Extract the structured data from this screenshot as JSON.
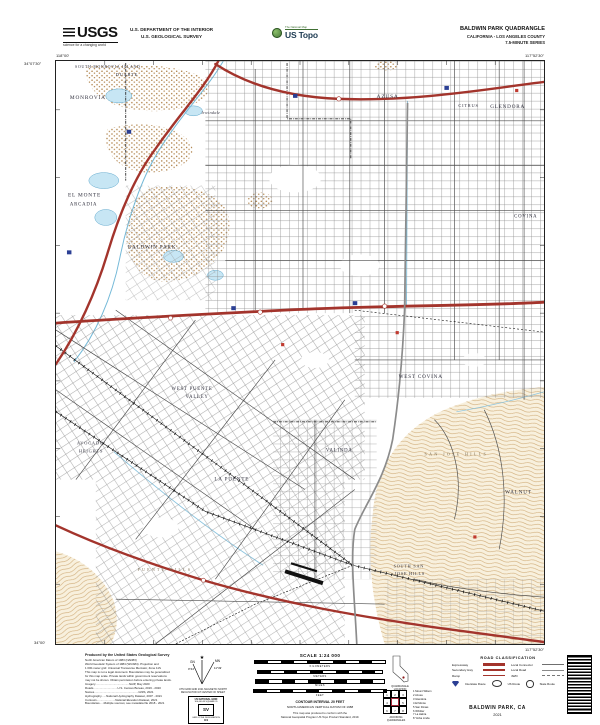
{
  "header": {
    "usgs": "USGS",
    "usgs_tagline": "science for a changing world",
    "dept1": "U.S. DEPARTMENT OF THE INTERIOR",
    "dept2": "U.S. GEOLOGICAL SURVEY",
    "ustopo_pre": "The National Map",
    "ustopo": "US Topo"
  },
  "title": {
    "line1": "BALDWIN PARK QUADRANGLE",
    "line2": "CALIFORNIA - LOS ANGELES COUNTY",
    "line3": "7.5-MINUTE SERIES"
  },
  "map": {
    "corners": {
      "tl_lon": "118°00'",
      "tl_lat": "34°07'30\"",
      "tr_lon": "117°52'30\"",
      "bl_lat": "34°00'",
      "br_lon": "117°52'30\""
    },
    "labels": {
      "south_monrovia_island": "SOUTH MONROVIA ISLAND",
      "duarte": "DUARTE",
      "monrovia": "MONROVIA",
      "irwindale": "Irwindale",
      "azusa": "AZUSA",
      "citrus": "CITRUS",
      "glendora": "GLENDORA",
      "covina": "COVINA",
      "el_monte": "EL MONTE",
      "arcadia": "ARCADIA",
      "baldwin_park": "BALDWIN PARK",
      "west_puente_1": "WEST PUENTE",
      "west_puente_2": "VALLEY",
      "west_covina": "WEST COVINA",
      "avocado_1": "AVOCADO",
      "avocado_2": "HEIGHTS",
      "la_puente": "LA PUENTE",
      "valinda": "VALINDA",
      "san_jose_hills": "SAN JOSE HILLS",
      "walnut": "WALNUT",
      "s_san_jose_1": "SOUTH SAN",
      "s_san_jose_2": "JOSE HILLS",
      "puente_hills": "PUENTE HILLS"
    },
    "colors": {
      "highway_red": "#a3342c",
      "water_fill": "#c7e6f4",
      "water_line": "#5fa8cc",
      "contour_tan": "#c79d63",
      "stipple_brown": "#aa7a3e",
      "shield_blue": "#2b3f94"
    }
  },
  "footer": {
    "produced_by": "Produced by the United States Geological Survey",
    "credits": [
      "North American Datum of 1983 (NAD83)",
      "World Geodetic System of 1984 (WGS84). Projection and",
      "1 000-meter grid: Universal Transverse Mercator, Zone 11S",
      "This map is not a legal document. Boundaries may be generalized",
      "for this map scale. Private lands within government reservations",
      "may not be shown. Obtain permission before entering private lands.",
      "Imagery..........................................NAIP, May 2020",
      "Roads..............................U.S. Census Bureau, 2016 - 2020",
      "Names.......................................................GNIS, 2021",
      "Hydrography......National Hydrography Dataset, 2007 - 2021",
      "Contours.......................National Elevation Dataset, 2021",
      "Boundaries.....Multiple sources; see metadata file 2018 - 2021"
    ],
    "declination": {
      "star": "★",
      "gn": "GN",
      "mn": "MN",
      "gn_val": "0°44'",
      "mn_val": "11°49'",
      "caption1": "UTM GRID AND 2021 MAGNETIC NORTH",
      "caption2": "DECLINATION AT CENTER OF SHEET"
    },
    "usng": {
      "title": "US NATIONAL GRID",
      "sub": "100,000-M SQUARE ID",
      "square": "SV",
      "gzd": "GRID ZONE DESIGNATION",
      "zone": "11S"
    },
    "scale": {
      "title": "SCALE 1:24 000",
      "units": [
        "KILOMETERS",
        "METERS",
        "MILES",
        "FEET"
      ],
      "contour": "CONTOUR INTERVAL 20 FEET",
      "datum": "NORTH AMERICAN VERTICAL DATUM OF 1988",
      "standard1": "This map was produced to conform with the",
      "standard2": "National Geospatial Program US Topo Product Standard, 2019."
    },
    "location": {
      "caption": "QUADRANGLE LOCATION"
    },
    "adjoining": {
      "caption": "ADJOINING QUADRANGLES",
      "cells": [
        "1",
        "2",
        "3",
        "4",
        "5",
        "6",
        "7",
        "8"
      ],
      "names": [
        "Mount Wilson",
        "Azusa",
        "Glendora",
        "El Monte",
        "San Dimas",
        "Whittier",
        "La Habra",
        "Yorba Linda"
      ]
    },
    "road_class": {
      "title": "ROAD CLASSIFICATION",
      "expressway": "Expressway",
      "secondary": "Secondary Hwy",
      "ramp": "Ramp",
      "local_connector": "Local Connector",
      "local_road": "Local Road",
      "fwd": "4WD",
      "interstate": "Interstate Route",
      "us_route": "US Route",
      "state_route": "State Route"
    },
    "map_name": "BALDWIN PARK, CA",
    "year": "2021"
  }
}
